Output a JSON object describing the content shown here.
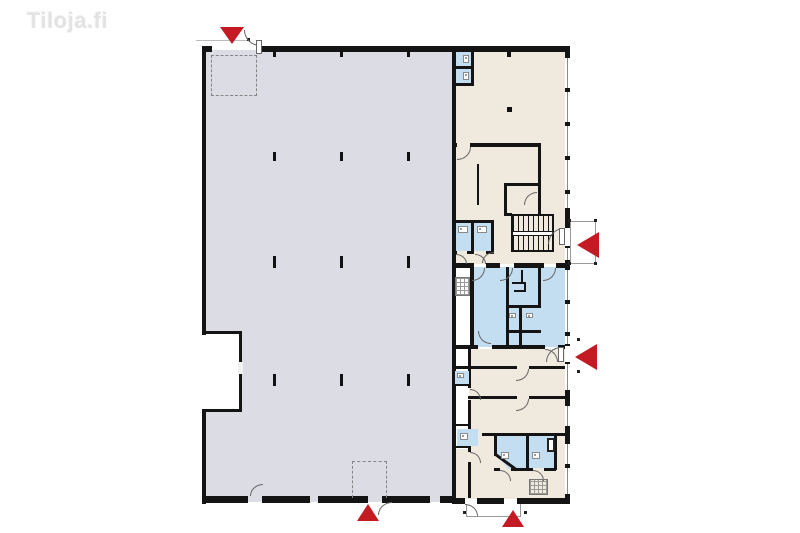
{
  "logo": {
    "text": "Tiloja.fi"
  },
  "colors": {
    "hall": "#dcdce5",
    "office": "#f0e9dd",
    "wet": "#c3ddf1",
    "wall": "#141414",
    "entrance": "#c41a24",
    "logo": "#e3e3e3"
  },
  "plan": {
    "type": "floor-plan",
    "areas": [
      {
        "id": "main-hall",
        "fill": "hall"
      },
      {
        "id": "office-wing-upper",
        "fill": "office"
      },
      {
        "id": "sanitary-block",
        "fill": "wet"
      },
      {
        "id": "office-wing-lower",
        "fill": "office"
      }
    ],
    "entrance_markers": [
      {
        "id": "north",
        "direction": "down"
      },
      {
        "id": "east-upper",
        "direction": "left"
      },
      {
        "id": "east-lower",
        "direction": "left"
      },
      {
        "id": "south-hall",
        "direction": "up"
      },
      {
        "id": "south-wing",
        "direction": "up"
      }
    ]
  }
}
